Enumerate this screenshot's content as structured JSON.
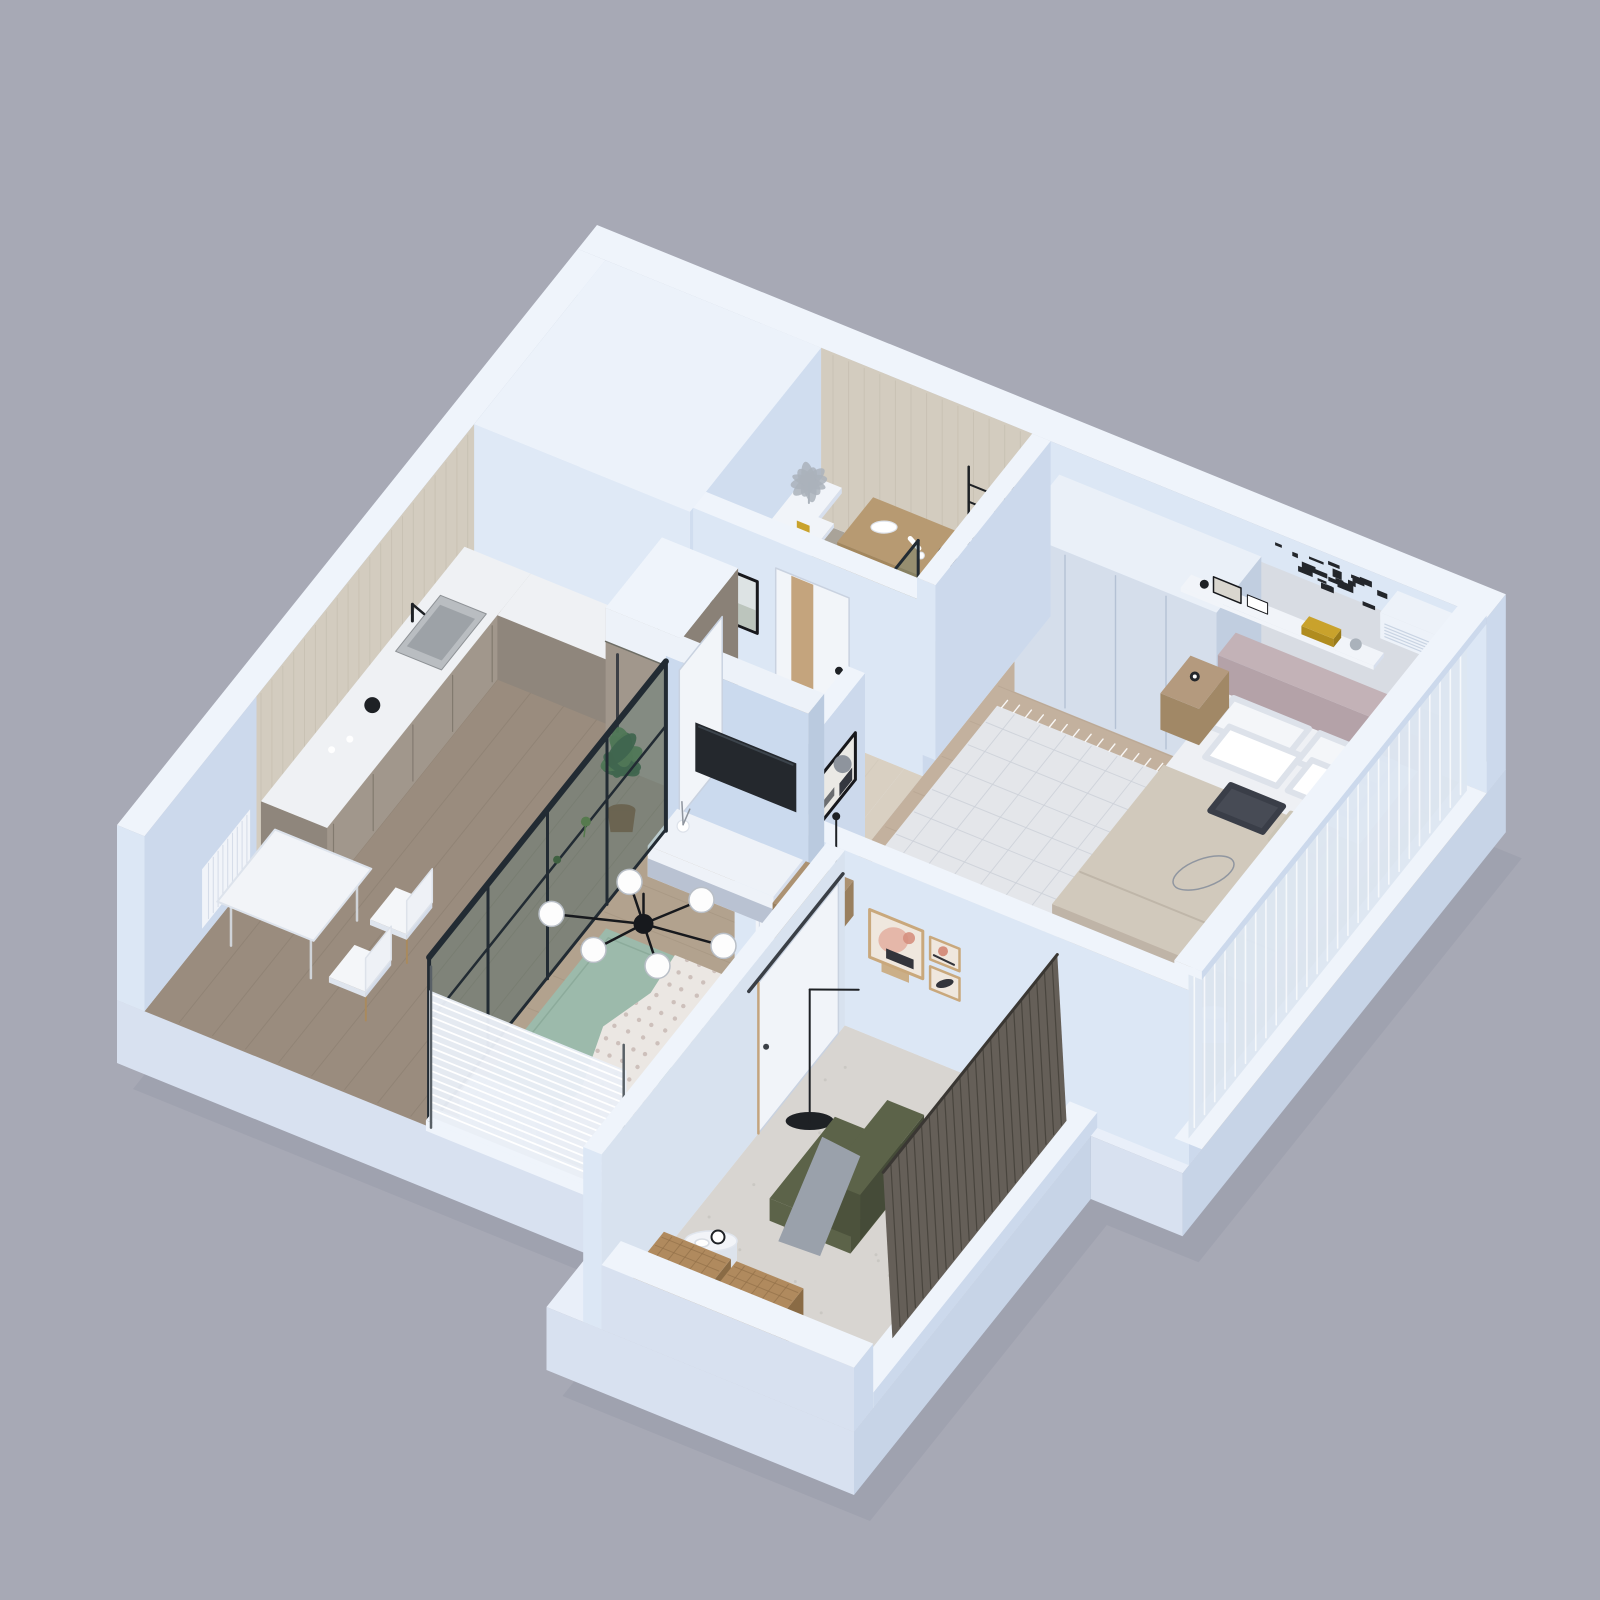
{
  "scene": {
    "title": "3D isometric cutaway render of a one-bedroom apartment floor plan",
    "type": "architectural-3d-floor-plan",
    "background": "#a7a9b5"
  },
  "rooms": [
    {
      "id": "bathroom",
      "label": "Bathroom / Laundry",
      "floor": "gray tile",
      "furniture": [
        "wall-shelf",
        "decorative-plant",
        "cosmetic-bottles",
        "wood-vanity",
        "hairdryer",
        "washing-machine",
        "towel-rack",
        "white-towel",
        "shower-glass-panel",
        "floor-lamp"
      ]
    },
    {
      "id": "hallway",
      "label": "Hallway",
      "floor": "cream tile",
      "furniture": [
        "framed-picture",
        "bathroom-door-with-wood-stripe",
        "white-open-door"
      ]
    },
    {
      "id": "kitchen",
      "label": "Kitchen / Dining",
      "floor": "gray-brown wood planks",
      "furniture": [
        "beige-tiled-wall",
        "kitchen-counter",
        "inset-sink",
        "black-faucet",
        "black-kettle",
        "cups",
        "upper-counter-return",
        "tall-fridge-cabinet",
        "potted-plant",
        "radiator-panel",
        "dining-table",
        "dining-chairs",
        "hanging-plant-sprigs"
      ]
    },
    {
      "id": "living-room",
      "label": "Living Room",
      "floor": "light wood planks",
      "furniture": [
        "tv-partition-wall",
        "wall-mounted-tv",
        "tv-cabinet",
        "decor-vase",
        "wood-side-table",
        "coffee-set",
        "thin-floor-lamp",
        "green-rug",
        "polka-dot-throw-blanket",
        "black-chandelier-six-globes",
        "wall-radiator",
        "window-radiator",
        "window-blinds",
        "glass-partition-black-frame"
      ]
    },
    {
      "id": "bedroom",
      "label": "Bedroom",
      "floor": "warm wood planks",
      "furniture": [
        "white-wardrobe",
        "double-bed",
        "mauve-headboard",
        "white-pillows",
        "dark-accent-cushion",
        "knit-cushion",
        "beige-duvet",
        "wire-sphere-decor",
        "wall-shelf-with-books",
        "gold-books",
        "black-word-art",
        "air-conditioner",
        "abstract-art-frame",
        "nightstand",
        "alarm-clock",
        "bedside-table",
        "floor-lamp-beige-shade",
        "patterned-rug",
        "sheer-curtain-window"
      ]
    },
    {
      "id": "reading-room",
      "label": "Reading Room / Loggia",
      "floor": "speckled concrete",
      "furniture": [
        "gallery-wall-three-frames",
        "arc-floor-lamp",
        "olive-armchair",
        "gray-throw",
        "round-side-table",
        "table-clock",
        "two-wicker-baskets",
        "dark-wood-blinds",
        "sliding-door"
      ]
    }
  ],
  "palette": {
    "bg": "#a7a9b5",
    "shadow": "#8f92a1",
    "slabTop": "#e9eff9",
    "baseS": "#d8e1f0",
    "baseE": "#c7d4e7",
    "cap": "#eff4fb",
    "innerS": "#dce7f5",
    "innerE": "#ccd9ec",
    "blockCap": "#ecf2fa",
    "blockS": "#dfe9f6",
    "blockE": "#d0ddef",
    "tile": "#d3ccbf",
    "tileLine": "#c7c0b2",
    "bathFloor": "#a9a399",
    "bathGrid": "#9b958b",
    "hallFloor": "#d9d0c2",
    "hallGrid": "#ccc3b4",
    "kitchenFloor": "#9a8c7e",
    "kitchenPlank": "#8b7e70",
    "livingFloor": "#b2a28e",
    "livingPlank": "#a2927e",
    "bedFloor": "#c3b19e",
    "bedPlank": "#b3a18e",
    "readFloor": "#d8d5d1",
    "readSpeckle": "#c7c4bf",
    "counterTop": "#eff1f4",
    "counterS": "#8f867c",
    "counterE": "#a1978c",
    "cabinetLine": "#766e64",
    "sinkSteel": "#b9bdc1",
    "sinkInner": "#9da2a7",
    "blackish": "#1e2125",
    "steel": "#aab2bb",
    "vanityTop": "#b79a72",
    "vanityS": "#a3875e",
    "washerWhite": "#f3f6fa",
    "washerDoor": "#aab4be",
    "washerRim": "#8d97a2",
    "towel": "#f6f8fb",
    "glassTint": "#41706c",
    "glassFrame": "#222b33",
    "doorWhite": "#f2f5f9",
    "doorWood": "#c4a47d",
    "doorShadow": "#c9d2e0",
    "artFrame": "#17181c",
    "artFill": "#eae9e5",
    "artDark": "#34373f",
    "artGray": "#8e949d",
    "landTop": "#dde3e4",
    "landBottom": "#bcc5bd",
    "wardrobeCap": "#eaf0f8",
    "wardrobeS": "#d5deeb",
    "wardrobeE": "#c1cee0",
    "wardrobeLine": "#b4c1d4",
    "panel": "#d8dce3",
    "mauveCap": "#c3b2b7",
    "mauveS": "#b4a2a8",
    "sheet": "#eef0f4",
    "duvet": "#d1c9bc",
    "duvetSide": "#bfb4a7",
    "mattressS": "#c8bcb0",
    "mattressE": "#cfc4b8",
    "pillow": "#f4f6f9",
    "pillowEdge": "#dde2ea",
    "cushionDark": "#474b55",
    "cushionKnit": "#dad4c6",
    "wire": "#9096a0",
    "nightstand": "#b49a7e",
    "nightstandS": "#a18866",
    "clockBlack": "#23262a",
    "shelfWhite": "#f1f4f9",
    "goldBook": "#c9a22c",
    "frameGray": "#d9d6cf",
    "wordArt": "#23262b",
    "acWhite": "#edf2f9",
    "acLine": "#c9d4e3",
    "rugBed": "#e4e6ea",
    "rugBedLine": "#cdd1d9",
    "lampShade": "#dccaa3",
    "lampShadeTop": "#e9dcbc",
    "lampStem": "#8a6d3f",
    "curtain": "#dde6f2",
    "curtainLine": "#f8fafd",
    "tvWallCap": "#edf2f9",
    "tvWallS": "#cbdaee",
    "tvWallE": "#bacadf",
    "tv": "#24282d",
    "tvSheen": "#3c444c",
    "cabWhite": "#eef2f8",
    "cabShadow": "#d7dfed",
    "cabGray": "#b9c2d2",
    "sideWood": "#ac9272",
    "sideWoodS": "#997f5e",
    "rugGreen": "#9cbaab",
    "rugGreenDark": "#8cab9b",
    "throw": "#ebe7e3",
    "throwDot": "#c8b8b4",
    "radW": "#f1f4f9",
    "radLine": "#d6dde9",
    "blindsW": "#e9eef6",
    "blindsWLine": "#ffffff",
    "postDark": "#596066",
    "chandBlack": "#17191d",
    "globe": "#fdfdfd",
    "globeEdge": "#b9bfc7",
    "rrWall": "#d8e2ef",
    "rrDoor": "#f1f4f9",
    "rrRail": "#3a3f46",
    "fPink": "#e5b7a9",
    "fPinkDark": "#d58f7e",
    "fTan": "#c9a87c",
    "fCream": "#efe7de",
    "fInk": "#33343b",
    "olive": "#5c6349",
    "oliveDark": "#4c523c",
    "throwGray": "#9aa1ab",
    "woodLeg": "#a98a5e",
    "tableW": "#f2f4f8",
    "tableWSide": "#dde3ec",
    "wicker": "#b08a5e",
    "wickerLine": "#93714a",
    "wickerS": "#9d7b50",
    "wickerE": "#8a6b45",
    "dBlind": "#655f58",
    "dBlindLine": "#49453e",
    "green": "#567a4e",
    "greenDark": "#3f6141",
    "potBrown": "#7d5f46",
    "white": "#ffffff"
  }
}
